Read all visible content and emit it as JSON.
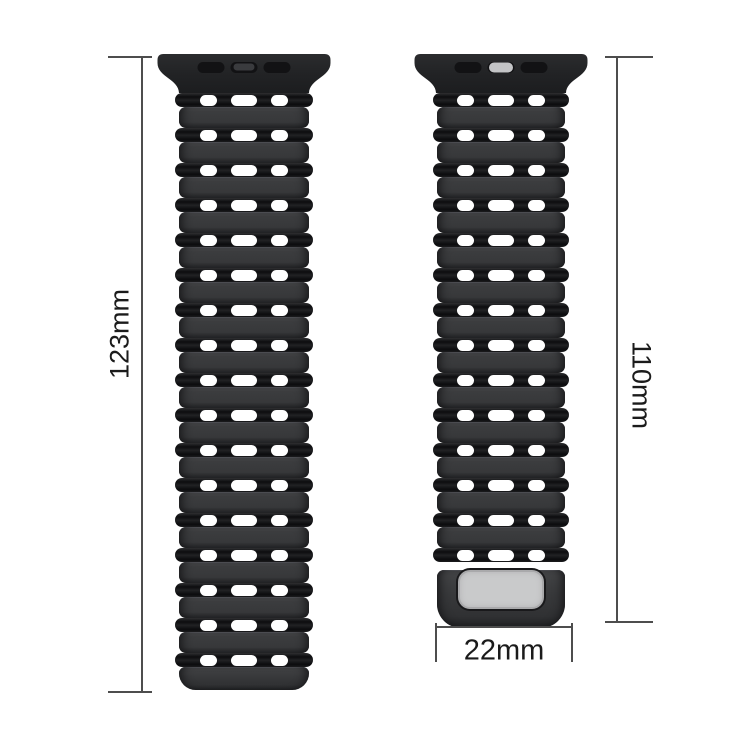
{
  "image": {
    "description": "silicone watch band two straps with size measurements",
    "background": "#ffffff"
  },
  "colors": {
    "strap_black": "#232426",
    "segment_gray": "#3a3b3d",
    "groove_black": "#0d0d0f",
    "hole_white": "#ffffff",
    "buckle_plate_gray": "#c9cacb",
    "connector_pill_gray": "#c3c4c6",
    "dimension_line": "#4d4d4d",
    "dimension_text": "#1b1b1b"
  },
  "straps": {
    "left": {
      "name": "long-strap",
      "hole_rows": 17,
      "holes_per_row": 3,
      "connector_slots": 3,
      "connector_pill": "dark",
      "has_buckle_plate": false
    },
    "right": {
      "name": "short-strap",
      "hole_rows": 14,
      "holes_per_row": 3,
      "connector_slots": 3,
      "connector_pill": "light",
      "has_buckle_plate": true
    }
  },
  "dimensions": {
    "left_length": "123mm",
    "right_length": "110mm",
    "width": "22mm"
  }
}
